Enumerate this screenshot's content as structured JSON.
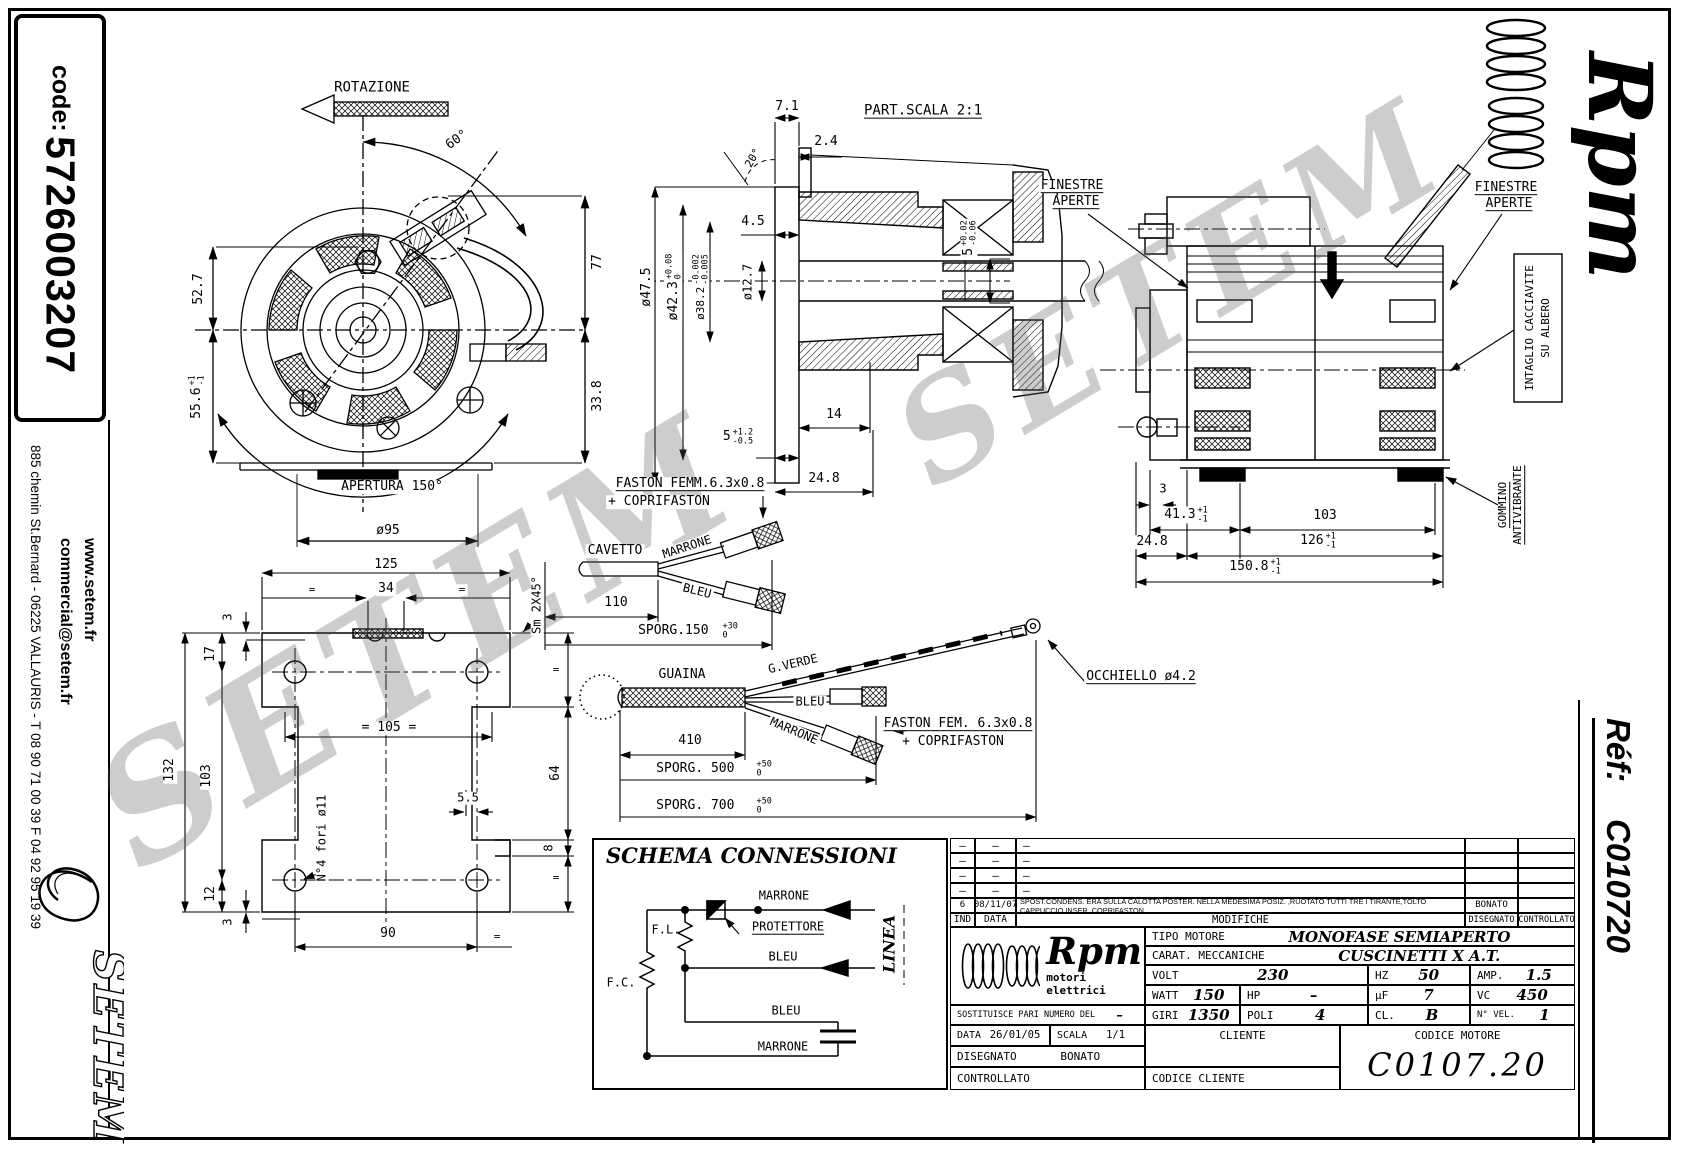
{
  "sidebar": {
    "code_label": "code:",
    "code_value": "5726003207",
    "website": "www.setem.fr",
    "email": "commercial@setem.fr",
    "address": "885 chemin St.Bernard  -  06225 VALLAURIS  -  T 08 90 71 00 39   F 04 92 95 19 39",
    "logo_text": "SETEM"
  },
  "brand": {
    "name": "Rpm",
    "tagline": "motori elettrici"
  },
  "ref_block": {
    "label": "Réf:",
    "value": "C010720"
  },
  "watermark": {
    "text": "SETEM"
  },
  "front_view": {
    "rotazione": "ROTAZIONE",
    "angle_60": "60°",
    "dim_52_7": "52.7",
    "dim_55_6": "55.6",
    "dim_55_6_up": "+1",
    "dim_55_6_dn": "-1",
    "dim_77": "77",
    "dim_33_8": "33.8",
    "apertura": "APERTURA 150°",
    "dia_95": "ø95"
  },
  "base_view": {
    "dim_125": "125",
    "dim_34": "34",
    "eq": "=",
    "dim_3_top": "3",
    "dim_17": "17",
    "dim_103": "103",
    "dim_132": "132",
    "dim_12": "12",
    "dim_3_bot": "3",
    "dim_105": "= 105 =",
    "dim_90": "90",
    "dim_5_5": "5.5",
    "dim_64": "64",
    "dim_8": "8",
    "fori_label": "N°4 fori ø11",
    "smusso_label": "Sm 2X45°"
  },
  "section_view": {
    "title": "PART.SCALA 2:1",
    "dim_7_1": "7.1",
    "dim_2_4": "2.4",
    "angle_20": "20°",
    "dim_4_5": "4.5",
    "dia_47_5": "ø47.5",
    "dia_42_3": "ø42.3",
    "dia_42_3_up": "+0.08",
    "dia_42_3_dn": "0",
    "dia_38_2": "ø38.2",
    "dia_38_2_up": "-0.002",
    "dia_38_2_dn": "-0.005",
    "dia_12_7": "ø12.7",
    "dim_14": "14",
    "dim_5_left": "5",
    "dim_5_left_up": "+1.2",
    "dim_5_left_dn": "-0.5",
    "dim_24_8": "24.8",
    "dim_5_right": "5",
    "dim_5_right_up": "+0.02",
    "dim_5_right_dn": "-0.06"
  },
  "side_view": {
    "finestre": "FINESTRE",
    "aperte": "APERTE",
    "intaglio_1": "INTAGLIO CACCIAVITE",
    "intaglio_2": "SU ALBERO",
    "gommino_1": "GOMMINO",
    "gommino_2": "ANTIVIBRANTE",
    "dim_3": "3",
    "dim_41_3": "41.3",
    "tol_up": "+1",
    "tol_dn": "-1",
    "dim_103": "103",
    "dim_24_8": "24.8",
    "dim_126": "126",
    "dim_150_8": "150.8"
  },
  "cable1": {
    "faston": "FASTON FEMM.6.3x0.8",
    "coprifaston": "+ COPRIFASTON",
    "cavetto": "CAVETTO",
    "marrone": "MARRONE",
    "bleu": "BLEU",
    "dim_110": "110",
    "sporg_150": "SPORG.150",
    "tol_up": "+30",
    "tol_dn": "0"
  },
  "cable2": {
    "guaina": "GUAINA",
    "g_verde": "G.VERDE",
    "bleu": "BLEU",
    "marrone": "MARRONE",
    "dim_410": "410",
    "sporg_500": "SPORG. 500",
    "sporg_700": "SPORG. 700",
    "tol_up": "+50",
    "tol_dn": "0",
    "faston": "FASTON FEM. 6.3x0.8",
    "coprifaston": "+ COPRIFASTON",
    "occhiello": "OCCHIELLO ø4.2"
  },
  "schema": {
    "title": "SCHEMA CONNESSIONI",
    "fl": "F.L.",
    "fc": "F.C.",
    "marrone_top": "MARRONE",
    "protettore": "PROTETTORE",
    "bleu_mid": "BLEU",
    "bleu_low": "BLEU",
    "marrone_low": "MARRONE",
    "linea": "LINEA"
  },
  "title_block": {
    "rev_headers": {
      "ind": "IND",
      "data": "DATA",
      "modifiche": "MODIFICHE",
      "disegnato": "DISEGNATO",
      "controllato": "CONTROLLATO"
    },
    "revisions": [
      {
        "ind": "–",
        "data": "–",
        "mod": "–",
        "dis": "",
        "con": ""
      },
      {
        "ind": "–",
        "data": "–",
        "mod": "–",
        "dis": "",
        "con": ""
      },
      {
        "ind": "–",
        "data": "–",
        "mod": "–",
        "dis": "",
        "con": ""
      },
      {
        "ind": "–",
        "data": "–",
        "mod": "–",
        "dis": "",
        "con": ""
      },
      {
        "ind": "6",
        "data": "08/11/07",
        "mod": "SPOST.CONDENS. ERA SULLA CALOTTA POSTER. NELLA MEDESIMA POSIZ. ,RUOTATO TUTTI TRE I TIRANTE,TOLTO CAPPUCCIO INSER. COPRIFASTON",
        "dis": "BONATO",
        "con": ""
      }
    ],
    "tipo_label": "TIPO MOTORE",
    "tipo_value": "MONOFASE SEMIAPERTO",
    "carat_label": "CARAT. MECCANICHE",
    "carat_value": "CUSCINETTI X A.T.",
    "volt_label": "VOLT",
    "volt": "230",
    "hz_label": "HZ",
    "hz": "50",
    "amp_label": "AMP.",
    "amp": "1.5",
    "watt_label": "WATT",
    "watt": "150",
    "hp_label": "HP",
    "hp": "–",
    "uf_label": "µF",
    "uf": "7",
    "vc_label": "VC",
    "vc": "450",
    "sost_label": "SOSTITUISCE PARI NUMERO DEL",
    "sost_value": "–",
    "giri_label": "GIRI",
    "giri": "1350",
    "poli_label": "POLI",
    "poli": "4",
    "cl_label": "CL.",
    "cl": "B",
    "nvel_label": "N° VEL.",
    "nvel": "1",
    "data_label": "DATA",
    "data_value": "26/01/05",
    "scala_label": "SCALA",
    "scala_value": "1/1",
    "cliente_label": "CLIENTE",
    "codice_motore_label": "CODICE MOTORE",
    "codice_motore": "C0107.20",
    "disegnato_label": "DISEGNATO",
    "disegnato_value": "BONATO",
    "controllato_label": "CONTROLLATO",
    "codice_cliente_label": "CODICE CLIENTE"
  }
}
